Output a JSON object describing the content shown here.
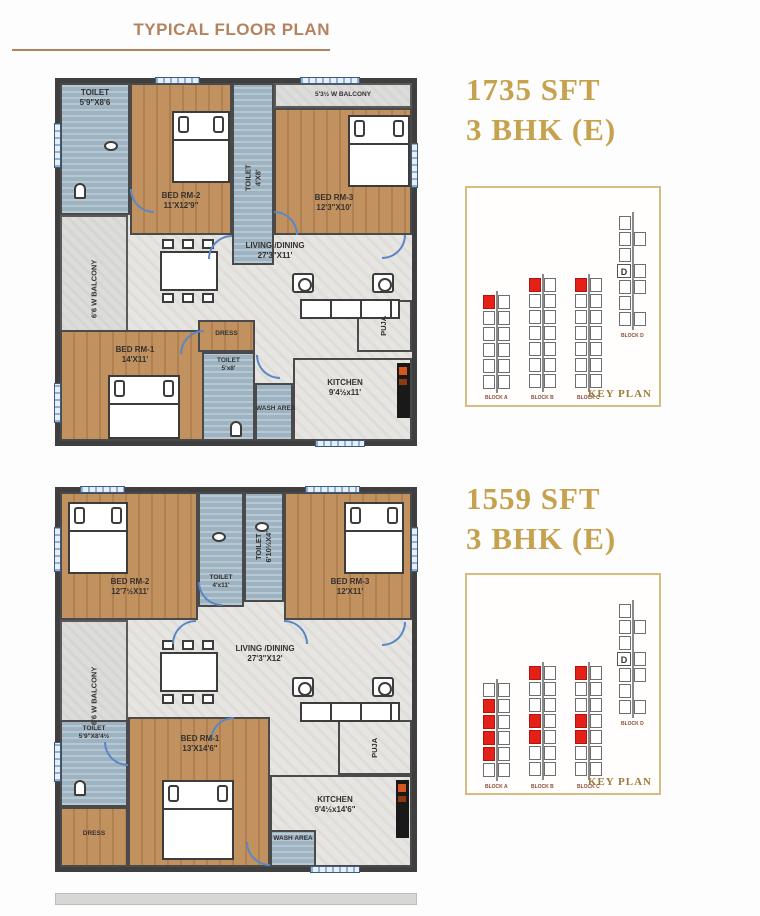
{
  "title": "TYPICAL FLOOR PLAN",
  "colors": {
    "accent_gold": "#c6a24e",
    "title_tan": "#b5825f",
    "highlight_red": "#e32119",
    "keyplan_border": "#d8bc82",
    "wall": "#3f3f3f",
    "wood": "#c29160",
    "wet_area_blue": "#9db3c2"
  },
  "plans": [
    {
      "area": "1735 SFT",
      "bhk": "3 BHK (E)",
      "rooms": {
        "toilet1": {
          "name": "TOILET",
          "dims": "5'9\"X8'6"
        },
        "bed2": {
          "name": "BED RM-2",
          "dims": "11'X12'9\""
        },
        "toilet2": {
          "name": "TOILET",
          "dims": "4'X8'"
        },
        "balcony_top": {
          "name": "5'3½ W BALCONY"
        },
        "bed3": {
          "name": "BED RM-3",
          "dims": "12'3\"X10'"
        },
        "balcony_left": {
          "name": "6'6 W BALCONY"
        },
        "living": {
          "name": "LIVING /DINING",
          "dims": "27'3\"X11'"
        },
        "bed1": {
          "name": "BED RM-1",
          "dims": "14'X11'"
        },
        "dress": {
          "name": "DRESS"
        },
        "toilet3": {
          "name": "TOILET",
          "dims": "5'x8'"
        },
        "wash": {
          "name": "WASH AREA"
        },
        "kitchen": {
          "name": "KITCHEN",
          "dims": "9'4½x11'"
        },
        "puja": {
          "name": "PUJA"
        }
      },
      "keyplan": {
        "label": "KEY PLAN",
        "blocks": [
          {
            "name": "BLOCK A",
            "units": 12,
            "red": [
              0
            ]
          },
          {
            "name": "BLOCK B",
            "units": 14,
            "red": [
              0
            ]
          },
          {
            "name": "BLOCK C",
            "units": 14,
            "red": [
              0
            ]
          },
          {
            "name": "BLOCK D",
            "label": "D"
          }
        ]
      }
    },
    {
      "area": "1559 SFT",
      "bhk": "3 BHK (E)",
      "rooms": {
        "bed2": {
          "name": "BED RM-2",
          "dims": "12'7½X11'"
        },
        "toilet_mid": {
          "name": "TOILET",
          "dims": "4'x11'"
        },
        "toilet_vert": {
          "name": "TOILET",
          "dims": "6'10½X4'"
        },
        "bed3": {
          "name": "BED RM-3",
          "dims": "12'X11'"
        },
        "balcony_left": {
          "name": "6'6 W BALCONY"
        },
        "living": {
          "name": "LIVING /DINING",
          "dims": "27'3\"X12'"
        },
        "toilet_bl": {
          "name": "TOILET",
          "dims": "5'9\"X8'4½"
        },
        "bed1": {
          "name": "BED RM-1",
          "dims": "13'X14'6\""
        },
        "dress": {
          "name": "DRESS"
        },
        "wash": {
          "name": "WASH AREA"
        },
        "kitchen": {
          "name": "KITCHEN",
          "dims": "9'4½x14'6\""
        },
        "puja": {
          "name": "PUJA"
        }
      },
      "keyplan": {
        "label": "KEY PLAN",
        "blocks": [
          {
            "name": "BLOCK A",
            "units": 12,
            "red": [
              2,
              4,
              6,
              8
            ]
          },
          {
            "name": "BLOCK B",
            "units": 14,
            "red": [
              0,
              6,
              8
            ]
          },
          {
            "name": "BLOCK C",
            "units": 14,
            "red": [
              0,
              6,
              8
            ]
          },
          {
            "name": "BLOCK D",
            "label": "D"
          }
        ]
      }
    }
  ]
}
